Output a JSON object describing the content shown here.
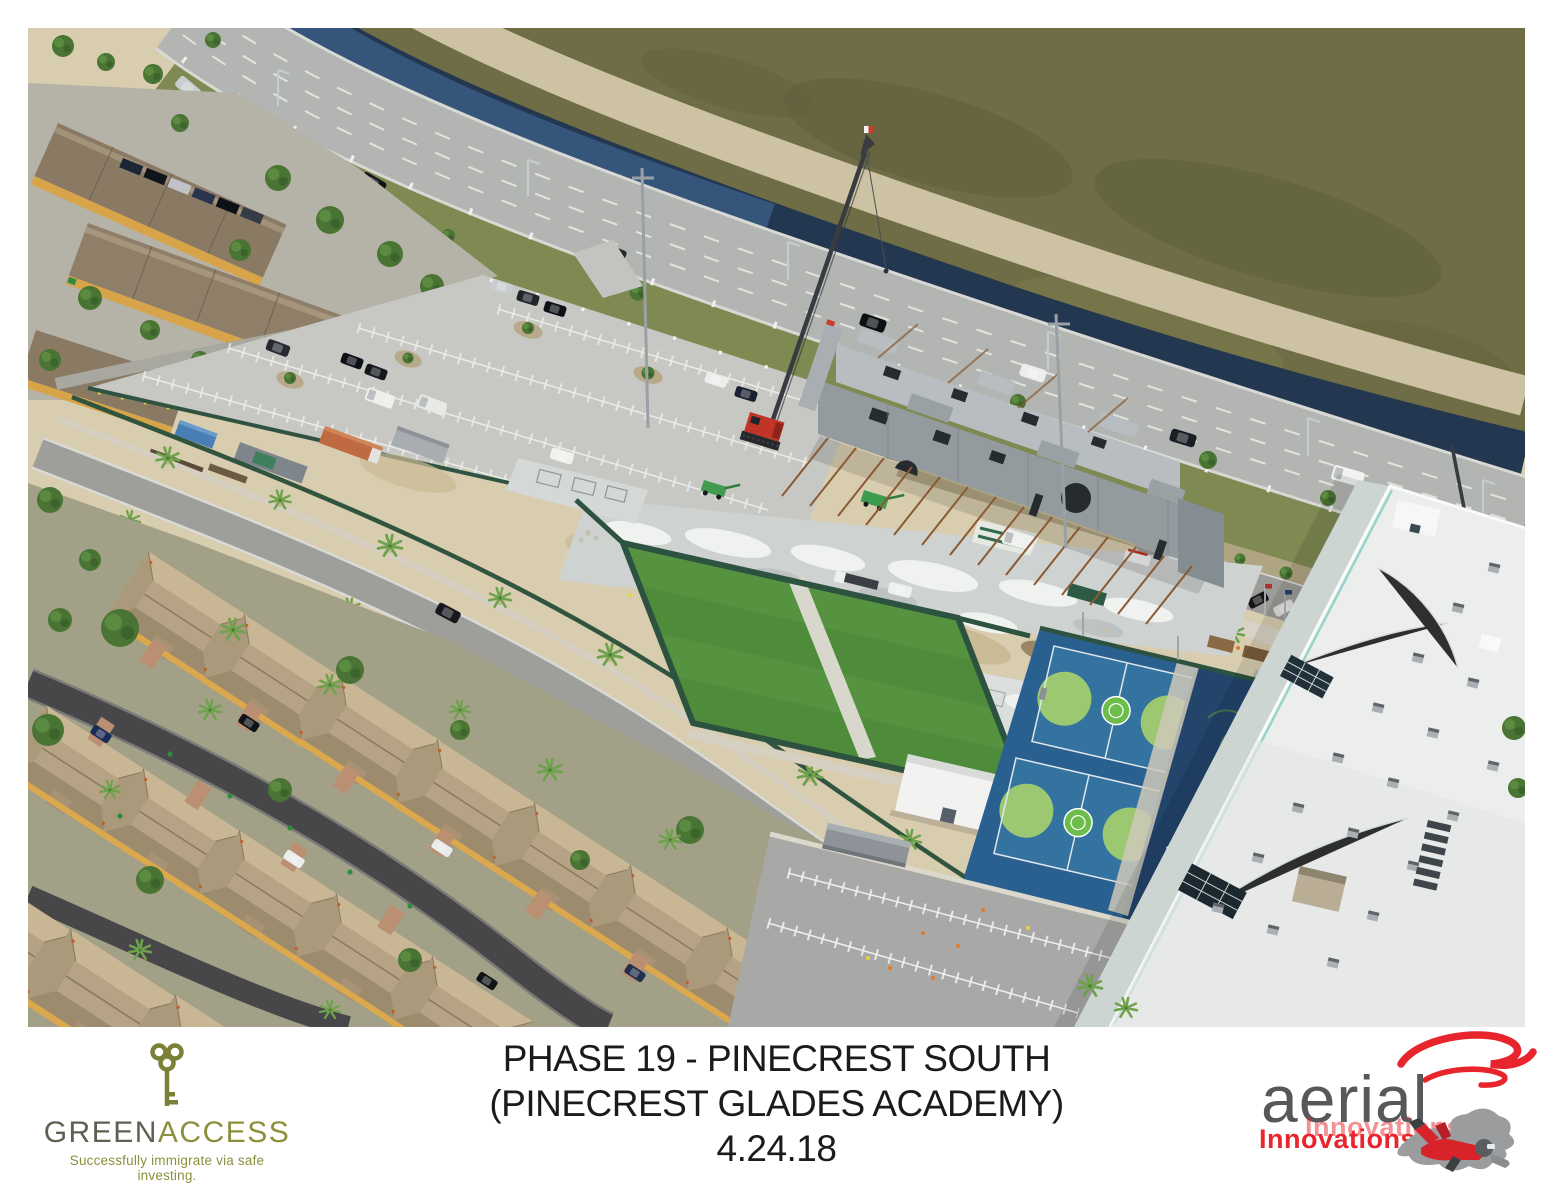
{
  "window": {
    "width": 1553,
    "height": 1200,
    "background": "#ffffff"
  },
  "photo_caption": {
    "line1": "PHASE 19 - PINECREST SOUTH",
    "line2": "(PINECREST GLADES ACADEMY)",
    "line3": "4.24.18",
    "text_color": "#1b1b1b"
  },
  "greenaccess_logo": {
    "name_green": "GREEN",
    "name_access": "ACCESS",
    "tagline": "Successfully immigrate via safe investing.",
    "green_color": "#5e6151",
    "olive_color": "#8d8f3d",
    "key_icon": "key",
    "key_color": "#7c8036"
  },
  "aerial_logo": {
    "brand": "aerial",
    "subbrand": "Innovations",
    "brand_color": "#57585a",
    "red_color": "#e8252c",
    "swirl_icon": "swirl",
    "skydiver_icon": "skydiver"
  },
  "photo": {
    "type": "oblique aerial photograph",
    "subject": "school construction site with tilt-up concrete walls, crane, new turf field, basketball courts, white school building, parking lots, highway, canal and residential neighborhood",
    "palette": {
      "sand": "#d9cdb0",
      "prairie_grass": "#6f6d45",
      "canal_water": "#233750",
      "highway": "#b2b5b1",
      "verge_grass": "#7e8a52",
      "turf_green": "#4e8c3b",
      "court_blue": "#3a78a3",
      "court_key_green": "#9cc872",
      "court_navy": "#23456b",
      "school_roof_white": "#eceeed",
      "concrete_wall_gray": "#9aa1a4",
      "crane_red": "#c23427",
      "roof_tan": "#b6a385",
      "house_yellow": "#dca84e",
      "street_asphalt": "#47474a",
      "fence_green": "#2d5340"
    }
  }
}
